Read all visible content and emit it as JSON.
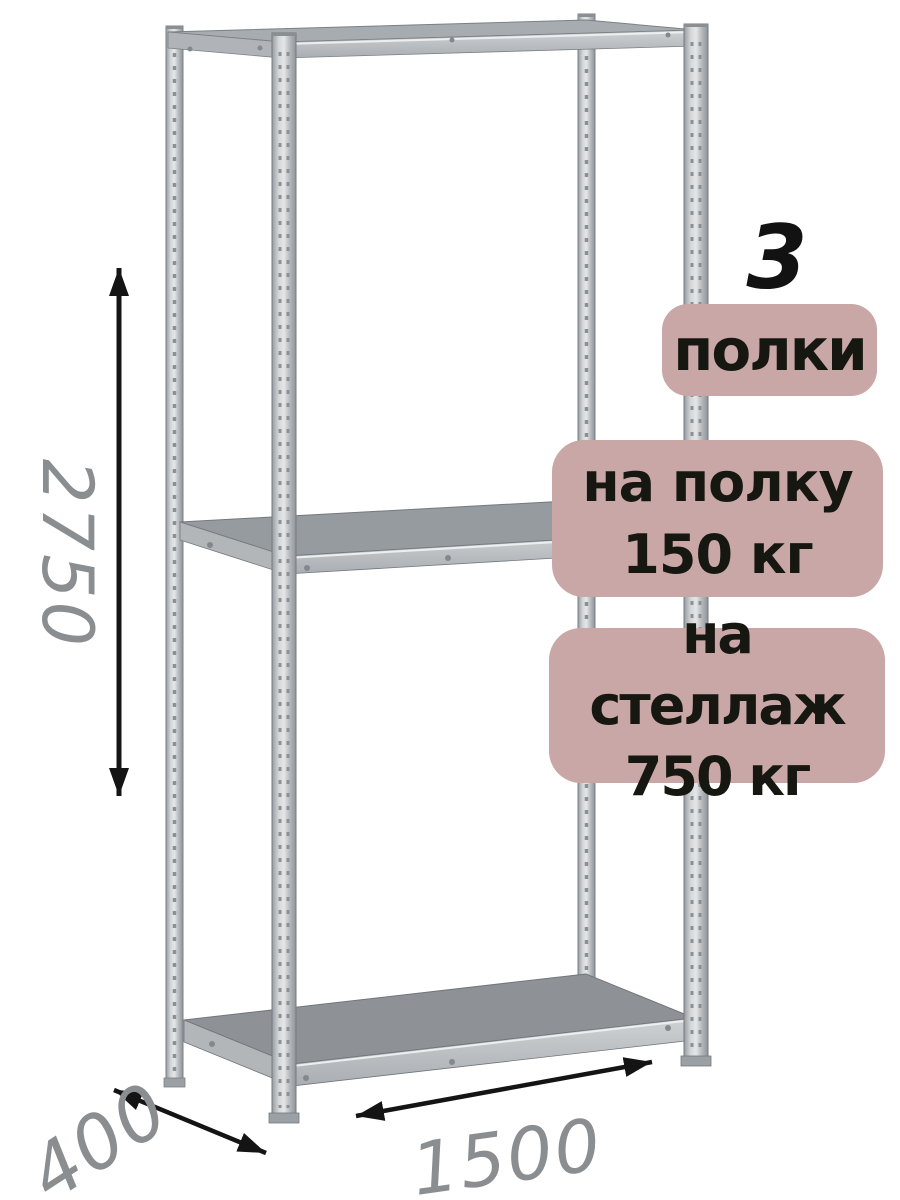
{
  "product": {
    "shelf_count": "3",
    "shelf_count_label": "полки",
    "shelf_load": {
      "line1": "на полку",
      "line2": "150 кг"
    },
    "rack_load": {
      "line1": "на стеллаж",
      "line2": "750 кг"
    }
  },
  "dimensions": {
    "height_mm": "2750",
    "depth_mm": "400",
    "width_mm": "1500"
  },
  "icons": {
    "height_arrow": "double-headed-vertical-arrow",
    "depth_arrow": "double-headed-diagonal-arrow",
    "width_arrow": "double-headed-horizontal-arrow"
  },
  "colors": {
    "background": "#ffffff",
    "badge_background": "#c8a7a6",
    "badge_text": "#171711",
    "shelf_count_text": "#121212",
    "dimension_text": "#8b8e91",
    "arrow": "#141414",
    "metal_light": "#d4d6d8",
    "metal_mid": "#a9aeb2",
    "metal_dark": "#8e9296"
  }
}
